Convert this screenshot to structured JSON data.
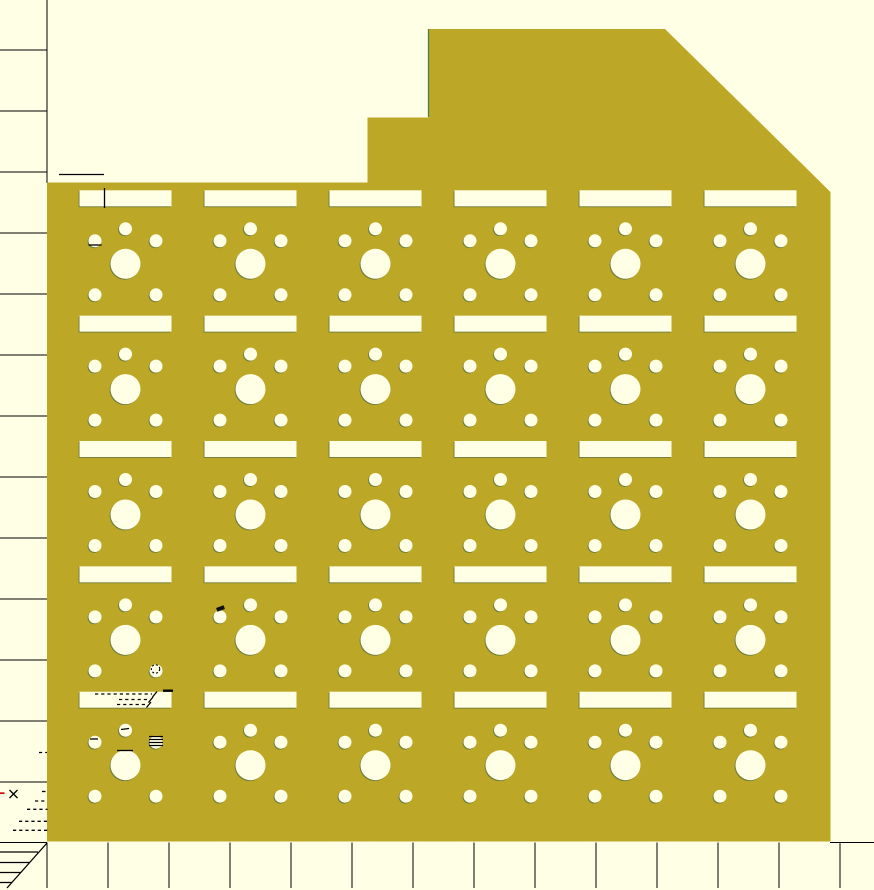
{
  "window": {
    "app_label": "OpenSCAD 2D preview viewport"
  },
  "canvas": {
    "width": 874,
    "height": 890,
    "background_color": "#FFFFE5"
  },
  "colors": {
    "plate_fill": "#BCA727",
    "hole_fill": "#FFFFE5",
    "edge_fringe": "#6E7E3E",
    "axis_line": "#000000",
    "stray_mark": "#000000",
    "red_mark": "#CC1111",
    "block_edge_green": "#4E7D4E"
  },
  "rulers": {
    "left": {
      "line_x": 47,
      "line_y1": 0,
      "line_y2": 183,
      "tick_x1": 0,
      "tick_x2": 47,
      "first_tick_y": 50,
      "tick_spacing": 61,
      "tick_count": 13
    },
    "bottom": {
      "line_y": 842.5,
      "line_segments": [
        [
          0,
          47
        ],
        [
          830,
          874
        ]
      ],
      "tick_y1": 842.5,
      "tick_y2": 888,
      "first_tick_x": 47,
      "tick_spacing": 61,
      "tick_count": 14
    }
  },
  "plate": {
    "outline_points": "47,182.5 367.5,182.5 367.5,117.5 428.5,117.5 428.5,29 665,29 830.5,192 830.5,841.5 47,841.5",
    "grid": {
      "columns": 6,
      "rows": 5,
      "first_center_x": 125.5,
      "pitch_x": 125,
      "first_slot_top_y": 190.3,
      "pitch_y": 125.35,
      "slot": {
        "width": 92,
        "height": 16
      },
      "top_hole": {
        "dy": 38.5,
        "r": 6.5
      },
      "side_holes": {
        "dx": 30.5,
        "dy": 50.5,
        "r": 6.5
      },
      "big_hole": {
        "dy": 73.5,
        "r": 15
      },
      "bottom_holes": {
        "dx": 30.5,
        "dy": 104.5,
        "r": 6.5
      }
    }
  },
  "annotations": [
    {
      "name": "stray-segment-above-plate",
      "kind": "line",
      "x1": 59,
      "y1": 174.5,
      "x2": 104,
      "y2": 174.5
    },
    {
      "name": "stray-segment-slot-r1c1",
      "kind": "line",
      "x1": 104.5,
      "y1": 188,
      "x2": 104.5,
      "y2": 208
    },
    {
      "name": "stray-underline-hole-r1c1",
      "kind": "line",
      "x1": 88.5,
      "y1": 245,
      "x2": 101.5,
      "y2": 245
    },
    {
      "name": "black-notch-hole-r4c2",
      "kind": "rect",
      "x": 216.5,
      "y": 606.5,
      "w": 8,
      "h": 4,
      "rot": -20,
      "color": "#111111"
    },
    {
      "name": "dashed-ring-hole-r4c1",
      "kind": "circle-dashed",
      "cx": 155.5,
      "cy": 669,
      "r": 4.2
    },
    {
      "name": "stray-corner-slot-r5c1",
      "kind": "rect",
      "x": 163,
      "y": 689.5,
      "w": 10,
      "h": 2.4,
      "color": "#000000"
    },
    {
      "name": "hidden-dash-line-1",
      "kind": "dline",
      "x1": 95,
      "y1": 694,
      "x2": 152,
      "y2": 694
    },
    {
      "name": "hidden-dash-slash-1",
      "kind": "line",
      "x1": 152.5,
      "y1": 697,
      "x2": 157,
      "y2": 691.5
    },
    {
      "name": "hidden-dash-line-2",
      "kind": "dline",
      "x1": 119,
      "y1": 699.5,
      "x2": 148,
      "y2": 699.5
    },
    {
      "name": "hidden-dash-slash-2",
      "kind": "line",
      "x1": 148.5,
      "y1": 702.5,
      "x2": 153,
      "y2": 697
    },
    {
      "name": "hidden-dash-line-3",
      "kind": "dline",
      "x1": 117,
      "y1": 704.5,
      "x2": 146,
      "y2": 704.5
    },
    {
      "name": "hidden-dash-slash-3",
      "kind": "line",
      "x1": 146.5,
      "y1": 707.5,
      "x2": 151,
      "y2": 702
    },
    {
      "name": "dash-in-top-hole-r5c1",
      "kind": "line",
      "x1": 121,
      "y1": 729.5,
      "x2": 129,
      "y2": 728.5
    },
    {
      "name": "dash-in-left-hole-r5c1",
      "kind": "line",
      "x1": 90,
      "y1": 739,
      "x2": 98,
      "y2": 739
    },
    {
      "name": "hatch-lines-right-hole-r5c1",
      "kind": "hlines",
      "x1": 149,
      "x2": 163,
      "y": 736.5,
      "count": 4,
      "gap": 3
    },
    {
      "name": "stray-tangent-bighole-r5c1",
      "kind": "line",
      "x1": 117,
      "y1": 750.5,
      "x2": 133,
      "y2": 750.5
    },
    {
      "name": "tiny-dash-pair-left-margin",
      "kind": "dline",
      "x1": 39,
      "y1": 752.5,
      "x2": 47,
      "y2": 752.5
    },
    {
      "name": "red-dash-left-margin",
      "kind": "rect",
      "x": 0,
      "y": 792.3,
      "w": 4.5,
      "h": 1.8,
      "color": "#CC1111"
    },
    {
      "name": "cross-mark-left-margin",
      "kind": "cross",
      "cx": 13.5,
      "cy": 794,
      "r": 4
    },
    {
      "name": "tiny-dash-right-of-cross",
      "kind": "line",
      "x1": 42,
      "y1": 791.5,
      "x2": 45.5,
      "y2": 791.5
    },
    {
      "name": "dash-row-1-left-margin",
      "kind": "dline",
      "x1": 35,
      "y1": 801,
      "x2": 47,
      "y2": 801
    },
    {
      "name": "dash-row-2-left-margin",
      "kind": "dline",
      "x1": 27,
      "y1": 809.3,
      "x2": 47.5,
      "y2": 809.3
    },
    {
      "name": "dash-row-3-left-margin",
      "kind": "dline",
      "x1": 19,
      "y1": 821.3,
      "x2": 47.5,
      "y2": 821.3
    },
    {
      "name": "dash-row-4-left-margin",
      "kind": "dline",
      "x1": 13,
      "y1": 830.3,
      "x2": 47.5,
      "y2": 830.3
    },
    {
      "name": "hatch-diagonal-origin",
      "kind": "line",
      "x1": 47,
      "y1": 843,
      "x2": 7,
      "y2": 888
    },
    {
      "name": "hatch-h1-origin",
      "kind": "line",
      "x1": 0,
      "y1": 852,
      "x2": 38,
      "y2": 852
    },
    {
      "name": "hatch-h2-origin",
      "kind": "line",
      "x1": 0,
      "y1": 862.5,
      "x2": 29.5,
      "y2": 862.5
    },
    {
      "name": "hatch-h3-origin",
      "kind": "line",
      "x1": 0,
      "y1": 872.5,
      "x2": 20.5,
      "y2": 872.5
    },
    {
      "name": "hatch-h4-origin",
      "kind": "line",
      "x1": 0,
      "y1": 882.5,
      "x2": 12,
      "y2": 882.5
    },
    {
      "name": "block-left-edge-highlight",
      "kind": "line",
      "x1": 428.5,
      "y1": 29,
      "x2": 428.5,
      "y2": 117,
      "color": "#4E7D4E"
    }
  ]
}
